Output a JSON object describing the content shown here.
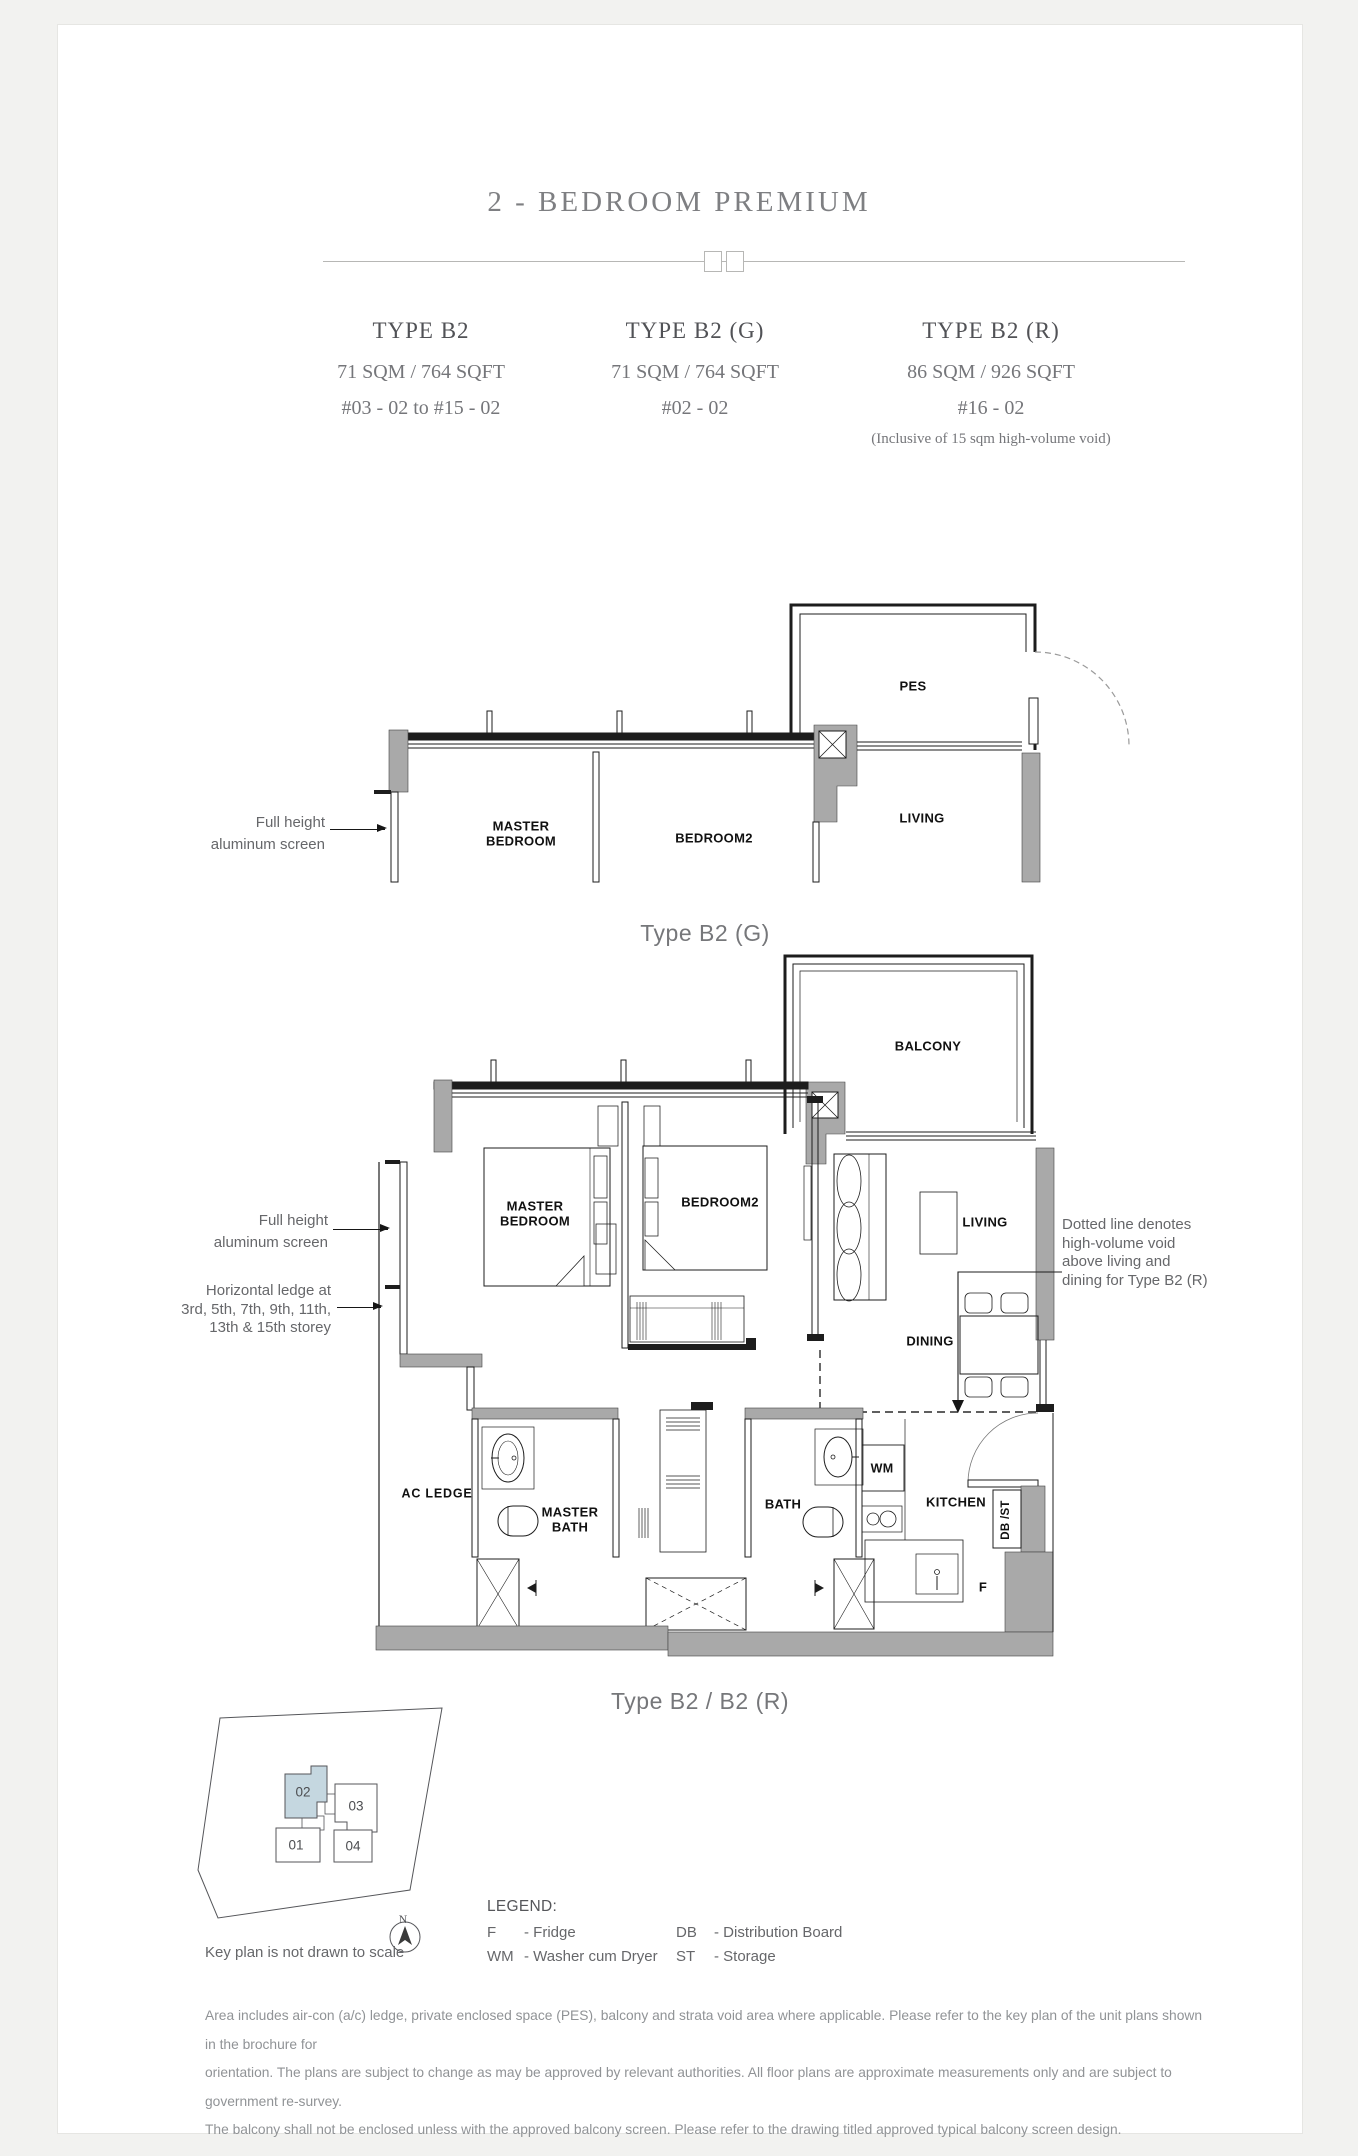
{
  "header": {
    "title": "2 - BEDROOM PREMIUM",
    "types": [
      {
        "name": "TYPE B2",
        "area": "71 SQM / 764 SQFT",
        "units": "#03 - 02 to #15 - 02",
        "note": ""
      },
      {
        "name": "TYPE B2 (G)",
        "area": "71 SQM / 764 SQFT",
        "units": "#02 - 02",
        "note": ""
      },
      {
        "name": "TYPE B2 (R)",
        "area": "86 SQM / 926 SQFT",
        "units": "#16 - 02",
        "note": "(Inclusive of 15 sqm high-volume void)"
      }
    ]
  },
  "plan_g": {
    "caption": "Type B2 (G)",
    "labels": {
      "pes": "PES",
      "master_bedroom": "MASTER\nBEDROOM",
      "bedroom2": "BEDROOM2",
      "living": "LIVING"
    },
    "annotations": {
      "screen": "Full height\naluminum screen"
    }
  },
  "plan_main": {
    "caption": "Type B2 / B2 (R)",
    "labels": {
      "balcony": "BALCONY",
      "master_bedroom": "MASTER\nBEDROOM",
      "bedroom2": "BEDROOM2",
      "living": "LIVING",
      "dining": "DINING",
      "ac_ledge": "AC  LEDGE",
      "master_bath": "MASTER\nBATH",
      "bath": "BATH",
      "wm": "WM",
      "kitchen": "KITCHEN",
      "db_st": "DB /ST",
      "fridge": "F"
    },
    "annotations": {
      "screen": "Full height\naluminum screen",
      "ledge": "Horizontal ledge at\n3rd, 5th, 7th, 9th, 11th,\n13th & 15th storey",
      "void": "Dotted line denotes\nhigh-volume void\nabove living and\ndining for Type B2 (R)"
    }
  },
  "keyplan": {
    "caption": "Key plan is not drawn to scale",
    "north_label": "N",
    "units": [
      {
        "id": "01",
        "highlighted": false
      },
      {
        "id": "02",
        "highlighted": true
      },
      {
        "id": "03",
        "highlighted": false
      },
      {
        "id": "04",
        "highlighted": false
      }
    ]
  },
  "legend": {
    "title": "LEGEND:",
    "items": [
      {
        "abbr": "F",
        "desc": "- Fridge"
      },
      {
        "abbr": "DB",
        "desc": "- Distribution Board"
      },
      {
        "abbr": "WM",
        "desc": "- Washer cum Dryer"
      },
      {
        "abbr": "ST",
        "desc": "- Storage"
      }
    ]
  },
  "disclaimer": {
    "line1": "Area includes air-con (a/c) ledge, private enclosed space (PES), balcony and strata void area where applicable. Please refer to the key plan of the unit plans shown in the brochure for",
    "line2": "orientation. The plans are subject to change as may be approved by relevant authorities. All floor plans are approximate measurements only and are subject to government re-survey.",
    "line3": "The balcony shall not be enclosed unless with the approved balcony screen. Please refer to the drawing titled approved typical balcony screen design."
  },
  "colors": {
    "wall_gray": "#a9a9a9",
    "line_dark": "#1d1d1d",
    "heading_gray": "#7e7f82",
    "annotation_gray": "#66676a",
    "keyplan_highlight": "#c5d7e0",
    "disclaimer_gray": "#909396"
  }
}
